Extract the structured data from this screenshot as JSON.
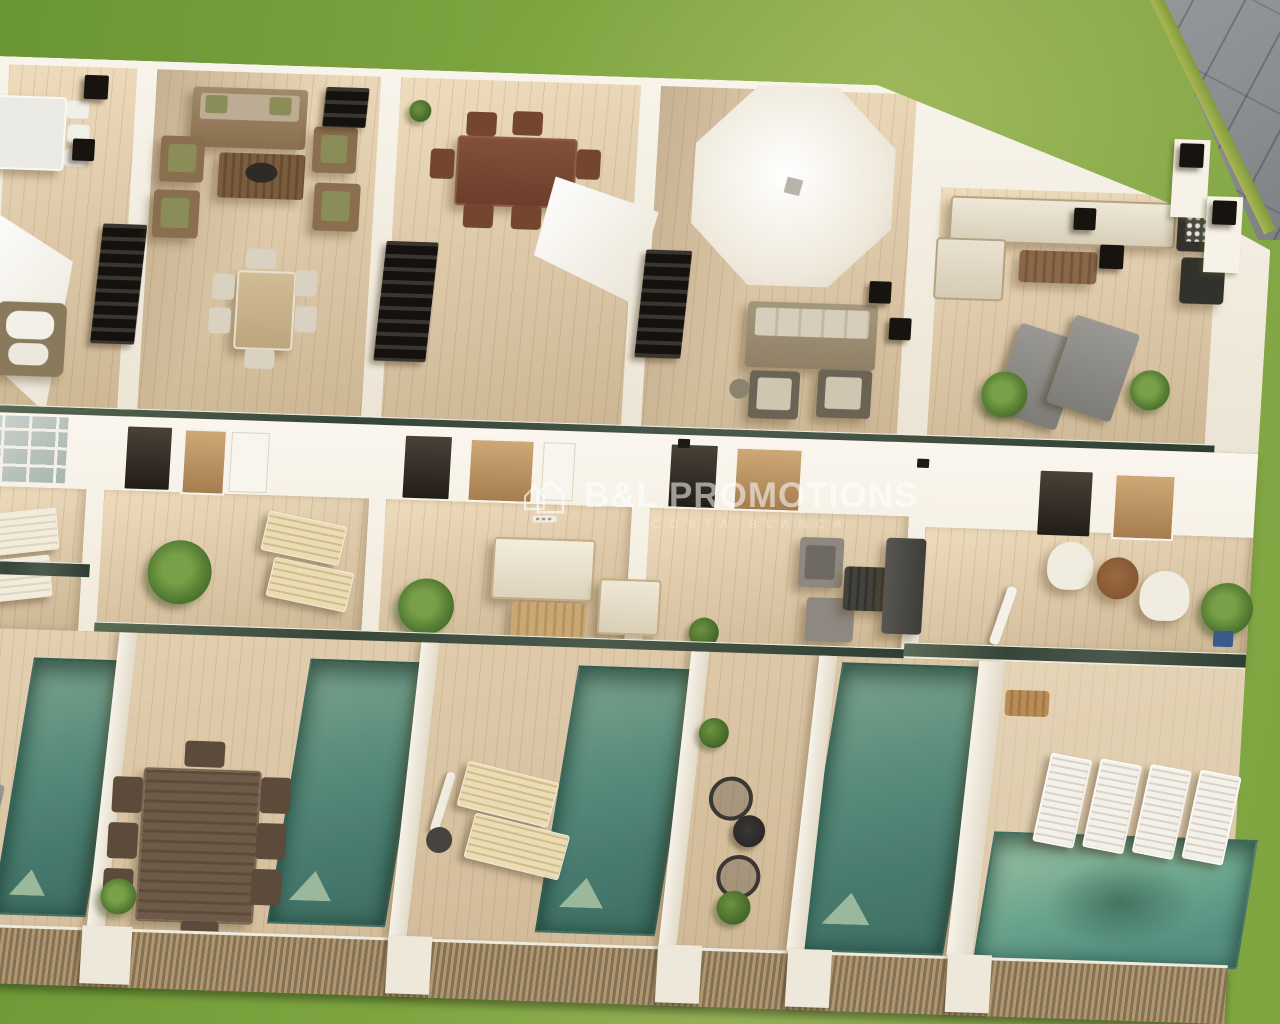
{
  "meta": {
    "image_type": "architectural-3d-render",
    "view": "aerial-oblique"
  },
  "watermark": {
    "brand": "B&L PROMOTIONS",
    "subtitle": "COSTA BLANCA",
    "logo_icon": "double-house-outline-icon"
  },
  "colors": {
    "grass": "#7da43f",
    "grass_deep": "#6a9634",
    "pavement": "#898c8e",
    "wall": "#f5f0e6",
    "wood_deck": "#d8c4a2",
    "pool": "#568a7a",
    "pool_large": "#6ea78f",
    "glass_rail": "#3c4b3f",
    "fence": "#b1976f",
    "sidewalk": "#56524a",
    "sidewalk_light": "#6b665c",
    "chimney": "#17130f",
    "plant": "#527a31"
  },
  "inventory": {
    "rooftop_solariums": {
      "count": 5,
      "items": [
        "white-dining-set",
        "shade-canopy",
        "wicker-armchair",
        "lounge-sofa-set",
        "slatted-coffee-table",
        "light-dining-set",
        "mahogany-dining-set",
        "shade-sail",
        "octagonal-parasol",
        "beige-sofa",
        "corner-sofa",
        "planter-boxes",
        "gray-sun-loungers",
        "palm-pots",
        "stairwell-openings",
        "chimneys"
      ]
    },
    "first_floor_terraces": {
      "count": 5,
      "items": [
        "glass-pergola",
        "cream-chaise-lounges",
        "palm-plant",
        "cream-sofa-set",
        "coffee-table",
        "armchair",
        "gray-wicker-chairs",
        "charcoal-sofa",
        "side-table",
        "barrel-chairs",
        "round-table",
        "closed-parasol",
        "glass-balustrades"
      ]
    },
    "gardens": {
      "count": 5,
      "pools": [
        "plunge-pool",
        "plunge-pool",
        "plunge-pool",
        "plunge-pool",
        "large-pool"
      ],
      "items": [
        "gray-loungers",
        "dark-wood-dining-set",
        "potted-plant",
        "closed-umbrella",
        "beige-loungers",
        "boxwood-shrubs",
        "bistro-set",
        "white-slatted-loungers",
        "timber-slat-fence",
        "white-fence-posts"
      ]
    },
    "surroundings": [
      "communal-lawn",
      "paved-walkway",
      "dark-sidewalk"
    ]
  }
}
